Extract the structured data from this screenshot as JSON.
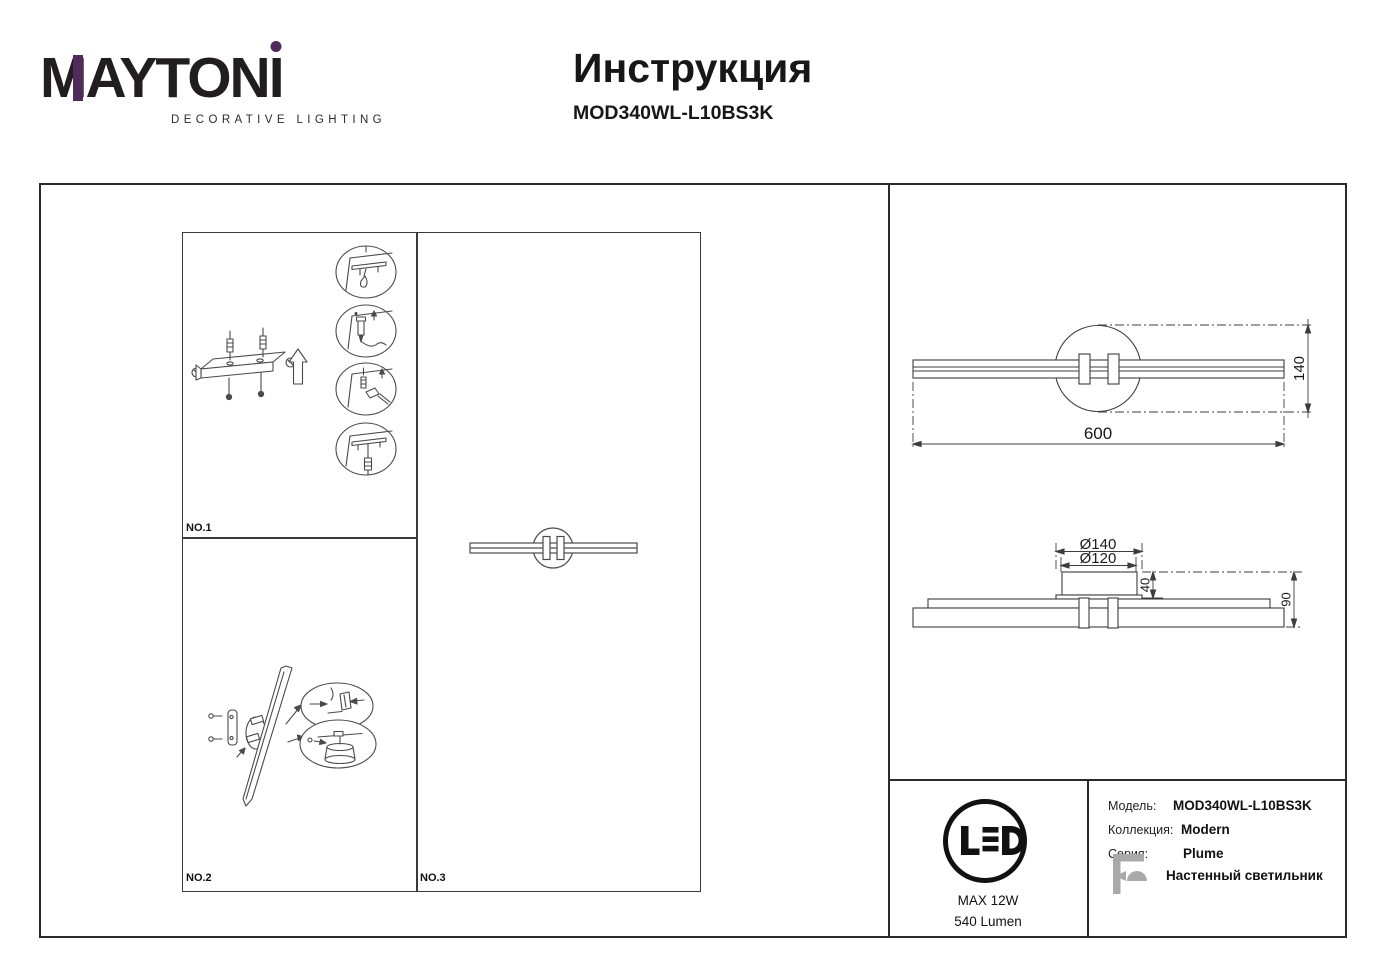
{
  "logo": {
    "brand_m": "M",
    "brand_rest": "AYTON",
    "brand_i": "I",
    "tagline": "DECORATIVE LIGHTING"
  },
  "header": {
    "title": "Инструкция",
    "model": "MOD340WL-L10BS3K"
  },
  "panels": {
    "no1": "NO.1",
    "no2": "NO.2",
    "no3": "NO.3"
  },
  "dimensions": {
    "front_height": "140",
    "front_width": "600",
    "base_outer_diameter": "Ø140",
    "base_inner_diameter": "Ø120",
    "base_depth": "40",
    "total_depth": "90"
  },
  "led_badge": {
    "label": "LED",
    "max_power": "MAX 12W",
    "lumen": "540 Lumen"
  },
  "specs": {
    "model_label": "Модель:",
    "model_value": "MOD340WL-L10BS3K",
    "collection_label": "Коллекция:",
    "collection_value": "Modern",
    "series_label": "Серия:",
    "series_value": "Plume",
    "type_value": "Настенный светильник"
  },
  "colors": {
    "accent_purple": "#4f2a5a",
    "line_art": "#4a4a4a",
    "icon_gray": "#a9a9a9",
    "frame": "#2b2b2b"
  }
}
